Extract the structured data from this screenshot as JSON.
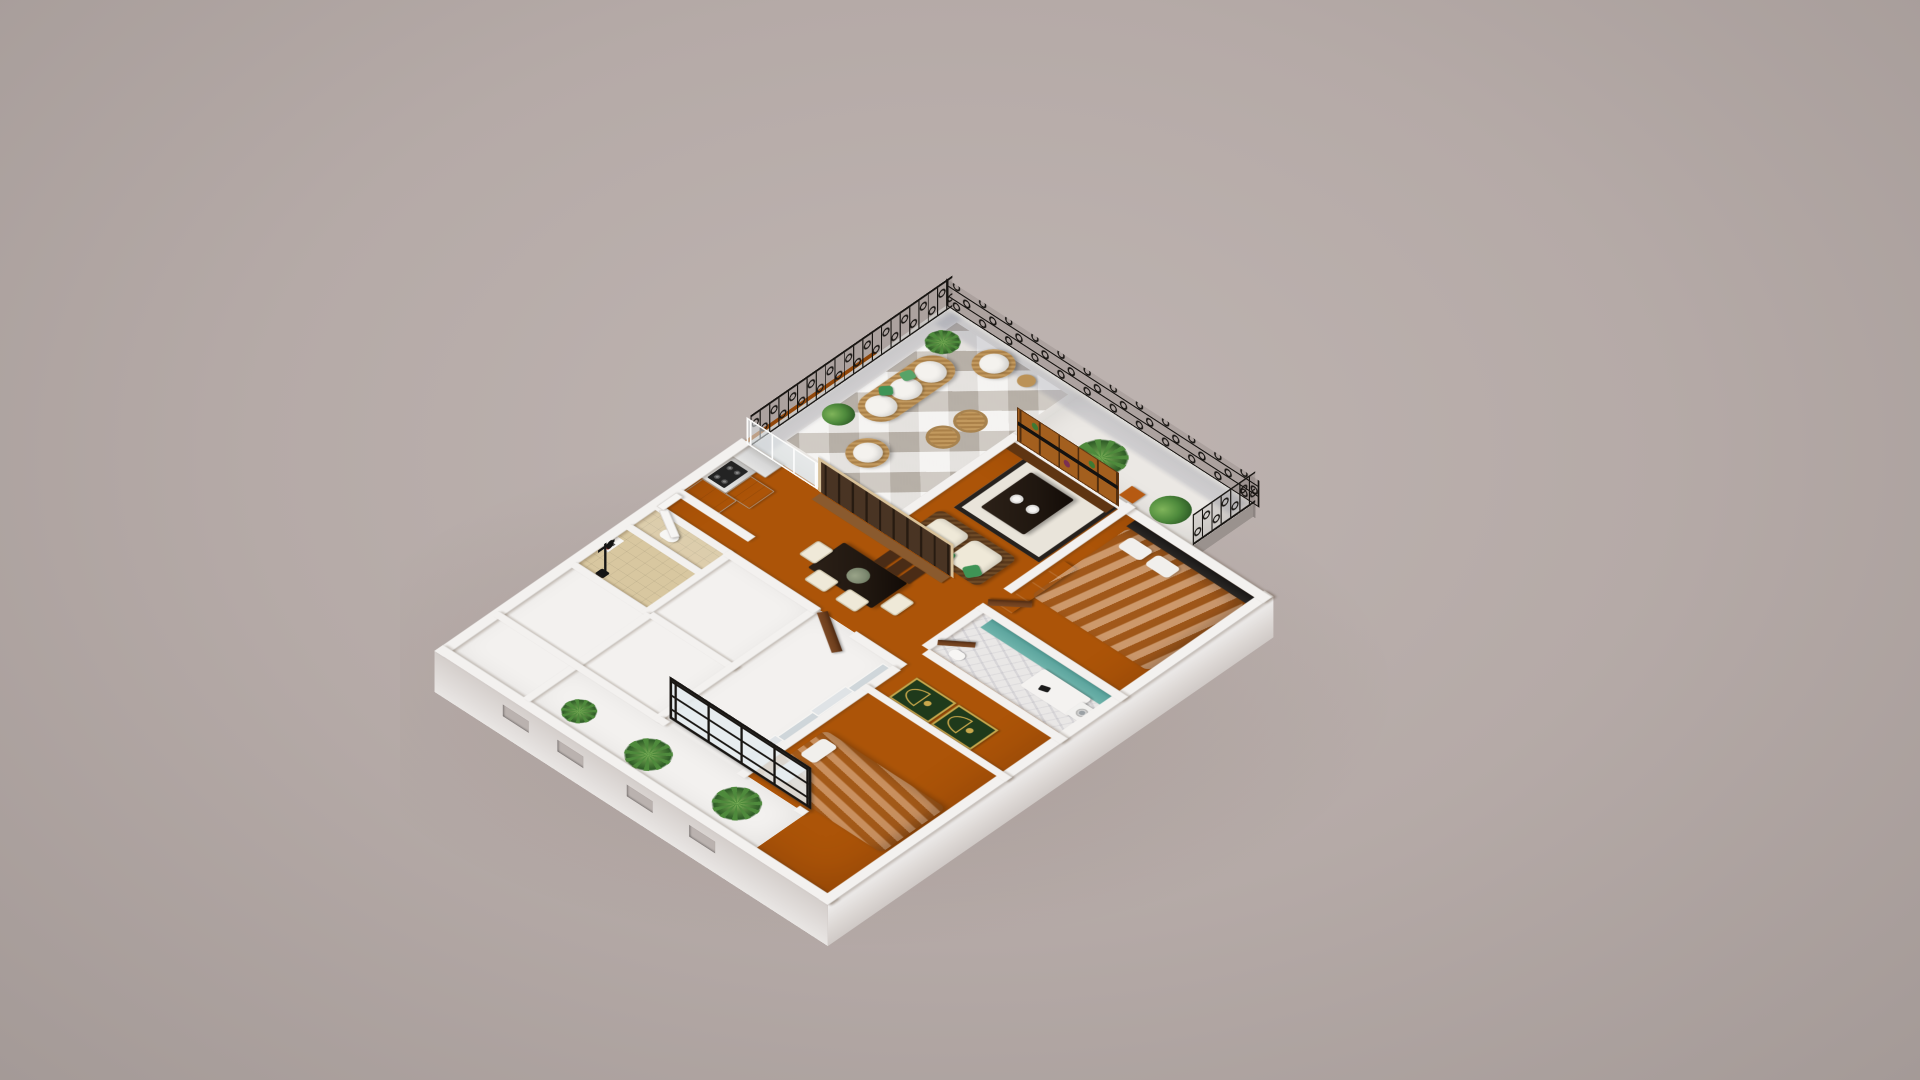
{
  "scene": {
    "kind": "3d-isometric-floorplan-render",
    "style": "cutaway apartment model on plain studio backdrop",
    "rooms": [
      {
        "name": "shower-room",
        "floor": "beige-tile",
        "items": [
          "shower-column",
          "wall-niche"
        ]
      },
      {
        "name": "toilet-room",
        "floor": "beige-tile",
        "items": [
          "toilet"
        ]
      },
      {
        "name": "entry-hall",
        "items": [
          "white-door"
        ]
      },
      {
        "name": "kitchen",
        "floor": "terracotta",
        "items": [
          "fridge",
          "cooktop-counter",
          "drawer-unit",
          "upper-cabinet",
          "glass-partition"
        ]
      },
      {
        "name": "balcony-terrace",
        "floor": "white-geometric-tile",
        "items": [
          "wrought-iron-railing",
          "wicker-sofa",
          "wicker-round-chair",
          "wicker-round-chair",
          "wicker-pouf",
          "wicker-pouf",
          "side-table",
          "planter-box",
          "palm-in-stone-pot",
          "corner-plant",
          "orange-stool"
        ]
      },
      {
        "name": "dining-foyer",
        "floor": "terracotta",
        "items": [
          "dark-dining-table",
          "four-cream-chairs",
          "flower-centerpiece",
          "wood-shelf-divider",
          "wood-step-shelves",
          "wood-door"
        ]
      },
      {
        "name": "living-area",
        "floor": "terracotta",
        "items": [
          "wicker-sofa-cream-cushions",
          "green-pillows",
          "cream-rug-black-border",
          "black-coffee-table",
          "two-white-bowls",
          "ladder-media-shelf"
        ]
      },
      {
        "name": "white-store-rooms",
        "floor": "white",
        "items": []
      },
      {
        "name": "dressing-room",
        "floor": "white",
        "items": [
          "sliding-closet-panels"
        ]
      },
      {
        "name": "indoor-garden",
        "floor": "white",
        "items": [
          "palm-plant",
          "palm-plant",
          "palm-plant",
          "black-grid-window-wall",
          "wall-window-slots"
        ]
      },
      {
        "name": "bedroom-1",
        "floor": "terracotta",
        "items": [
          "double-bed-white-duvet",
          "pillows"
        ]
      },
      {
        "name": "prayer-room",
        "floor": "terracotta",
        "items": [
          "green-prayer-rug",
          "green-prayer-rug"
        ]
      },
      {
        "name": "bathroom",
        "floor": "marble",
        "items": [
          "teal-counter",
          "vanity",
          "toilet",
          "washing-machine",
          "wood-door"
        ]
      },
      {
        "name": "bedroom-2",
        "floor": "terracotta",
        "items": [
          "double-bed-gray-duvet",
          "black-headboard",
          "wardrobe",
          "wood-door"
        ]
      }
    ]
  },
  "colors": {
    "background": "#b5aaa7",
    "background_center": "#bfb5b2",
    "background_edge": "#a49a97",
    "wall": "#f3f1ef",
    "floor": "#ac5408",
    "balcony_floor": "#ebe8e4",
    "railing": "#181512",
    "bath_tile": "#d8c7a0",
    "marble": "#e9e7e6",
    "teal": "#5fa7a0",
    "rug_cream": "#e9e4da",
    "rug_border": "#26211d",
    "prayer_green": "#1f3a1b",
    "prayer_gold": "#c9a84c",
    "wicker": "#c2995e",
    "wicker_dark": "#6e4a26",
    "cushion_cream": "#efe9d8",
    "pillow_green": "#3f9456",
    "wood_door": "#6e3f1e",
    "wood_divider": "#d9c29a",
    "wood_shelf": "#a35f1e",
    "table_black": "#201710",
    "bed_light": "#dddbd8",
    "headboard": "#1a1817",
    "plant_dark": "#2e5c26",
    "plant_mid": "#4e8a3c",
    "plant_light": "#7fb45a",
    "pot": "#8a6a42",
    "glass": "#dfe7ea",
    "metal": "#d8d8d8",
    "cooktop": "#232323"
  }
}
